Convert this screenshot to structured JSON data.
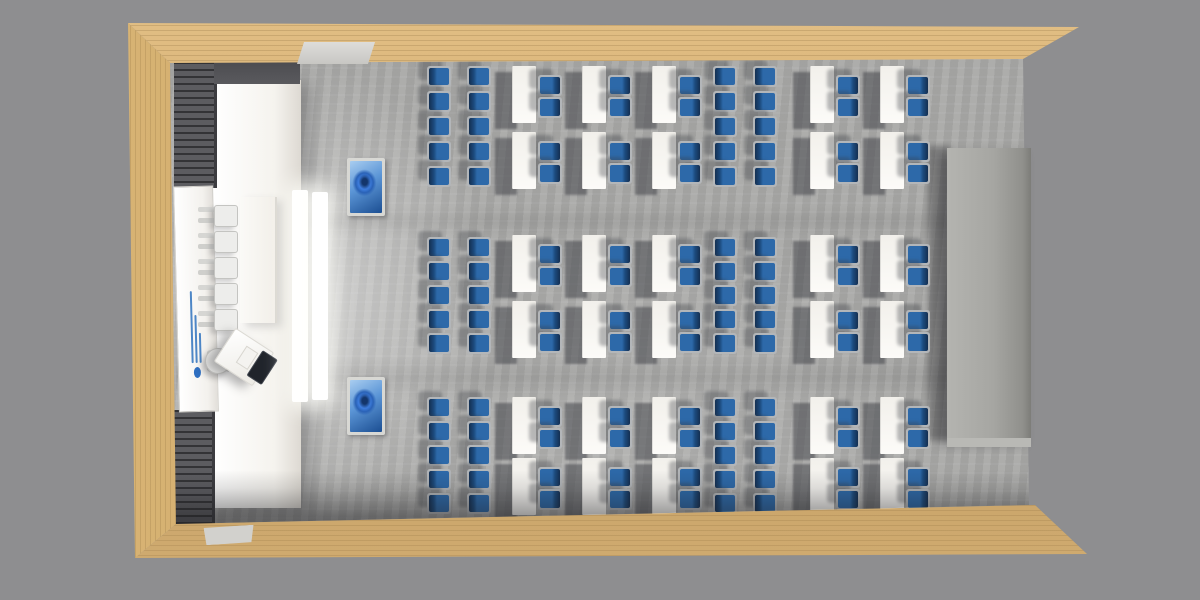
{
  "view": {
    "type": "3d-architectural-render",
    "projection": "top-down perspective",
    "subject": "classroom seating layout with wooden walls, gray carpet, blue student chairs and white tables"
  },
  "palette": {
    "background": "#8e8e90",
    "wood_light": "#dcb878",
    "wood_dark": "#7e6a40",
    "floor_gray": "#a8a8a6",
    "shadow_gray": "#3a3c42",
    "table_white": "#f6f4ef",
    "chair_seat_blue": "#2d69a9",
    "chair_back_navy": "#16385e",
    "chair_frame_gray": "#b3b6b9",
    "acoustic_panel_dark": "#55555a",
    "cabinet_gray": "#a6a6a2",
    "screen_glow_white": "#ffffff",
    "tv_wallpaper_blue": "#2f6fd0",
    "board_logo_blue": "#2f6fc1"
  },
  "seating": {
    "chair_size": {
      "w": 24,
      "h": 21
    },
    "table_size": {
      "w": 24,
      "h": 57
    },
    "standalone_chair_cols_x": [
      427,
      467,
      713,
      753
    ],
    "table_cols_x": [
      512,
      582,
      652,
      810,
      880
    ],
    "table_chair_dx": 26,
    "table_chair_dys": [
      9,
      31
    ],
    "bands": [
      {
        "chair_rows_y": [
          66,
          91,
          116,
          141,
          166
        ],
        "table_rows_y": [
          66,
          132
        ]
      },
      {
        "chair_rows_y": [
          237,
          261,
          285,
          309,
          333
        ],
        "table_rows_y": [
          235,
          301
        ]
      },
      {
        "chair_rows_y": [
          397,
          421,
          445,
          469,
          493
        ],
        "table_rows_y": [
          397,
          458
        ]
      }
    ],
    "totals": {
      "tables": 30,
      "blue_chairs_at_tables": 60,
      "standalone_blue_chairs": 60
    }
  },
  "front_zone": {
    "white_column": {
      "x": 213,
      "y": 80,
      "w": 88,
      "h": 428
    },
    "wall_cap": {
      "x": 214,
      "y": 62,
      "w": 86,
      "h": 22
    },
    "acoustic_panels": [
      {
        "x": 174,
        "y": 62,
        "w": 43,
        "h": 126
      },
      {
        "x": 174,
        "y": 410,
        "w": 41,
        "h": 114
      }
    ],
    "whiteboard": {
      "x": 176,
      "y": 186,
      "w": 40,
      "h": 226,
      "logo_line_widths": [
        72,
        48,
        30
      ]
    },
    "projection_screens": [
      {
        "x": 292,
        "y": 190,
        "w": 16,
        "h": 212
      },
      {
        "x": 312,
        "y": 192,
        "w": 16,
        "h": 208
      }
    ],
    "head_table": {
      "x": 240,
      "y": 197,
      "w": 37,
      "h": 126
    },
    "white_guest_chairs": {
      "x": 198,
      "rows_y": [
        204,
        230,
        256,
        282,
        308
      ],
      "count": 5
    },
    "presenter_chair": {
      "x": 202,
      "y": 346
    },
    "podium": {
      "x": 221,
      "y": 337,
      "w": 46,
      "h": 40,
      "rotation_deg": 33
    }
  },
  "wall_fixtures": {
    "tvs": [
      {
        "x": 347,
        "y": 158,
        "w": 38,
        "h": 58
      },
      {
        "x": 347,
        "y": 377,
        "w": 38,
        "h": 58
      }
    ],
    "cabinet": {
      "x": 947,
      "y": 148,
      "w": 84,
      "h": 290
    },
    "doors": {
      "top": {
        "x": 297,
        "y": 42,
        "w": 78,
        "h": 22
      },
      "bottom": {
        "x": 204,
        "y": 526,
        "w": 50,
        "h": 18
      }
    }
  }
}
